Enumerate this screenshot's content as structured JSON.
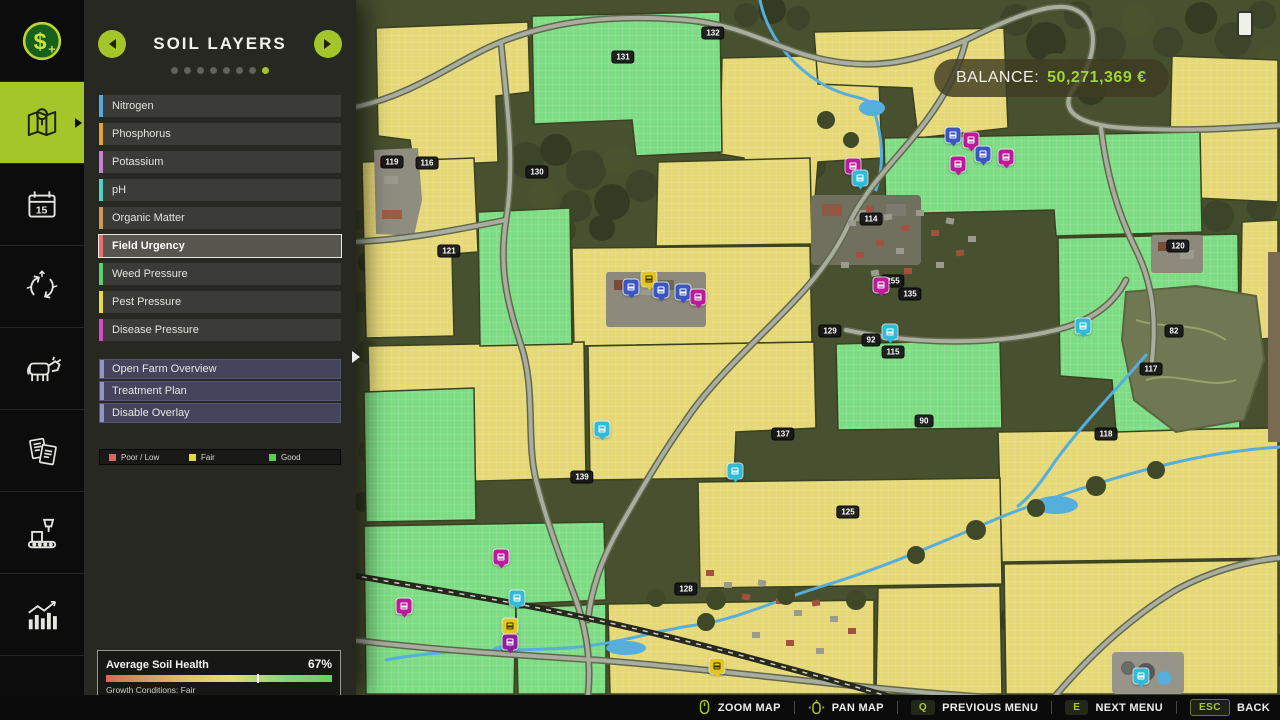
{
  "sidebar": {
    "items": [
      {
        "icon": "money",
        "active": false
      },
      {
        "icon": "map",
        "active": true
      },
      {
        "icon": "calendar",
        "active": false
      },
      {
        "icon": "crop-rotation",
        "active": false
      },
      {
        "icon": "animals",
        "active": false
      },
      {
        "icon": "contracts",
        "active": false
      },
      {
        "icon": "production",
        "active": false
      },
      {
        "icon": "statistics",
        "active": false
      },
      {
        "icon": "help",
        "active": false
      }
    ]
  },
  "panel": {
    "title": "SOIL LAYERS",
    "dots_total": 8,
    "dot_active_index": 7,
    "layers": [
      {
        "label": "Nitrogen",
        "color": "#5aa8e0"
      },
      {
        "label": "Phosphorus",
        "color": "#e0a33c"
      },
      {
        "label": "Potassium",
        "color": "#c77fd4"
      },
      {
        "label": "pH",
        "color": "#4fd4c8"
      },
      {
        "label": "Organic Matter",
        "color": "#cf9a52"
      },
      {
        "label": "Field Urgency",
        "color": "#e8706c"
      },
      {
        "label": "Weed Pressure",
        "color": "#5ccf6e"
      },
      {
        "label": "Pest Pressure",
        "color": "#e8d84a"
      },
      {
        "label": "Disease Pressure",
        "color": "#d84ac4"
      }
    ],
    "selected_layer_index": 5,
    "actions": [
      {
        "label": "Open Farm Overview"
      },
      {
        "label": "Treatment Plan"
      },
      {
        "label": "Disable Overlay"
      }
    ],
    "legend": [
      {
        "label": "Poor / Low",
        "color": "#e0635c"
      },
      {
        "label": "Fair",
        "color": "#e3d93c"
      },
      {
        "label": "Good",
        "color": "#53cf53"
      }
    ],
    "soil_health": {
      "title": "Average Soil Health",
      "percent": 67,
      "percent_label": "67%",
      "caption": "Growth Conditions: Fair"
    }
  },
  "hud": {
    "balance_label": "BALANCE:",
    "balance_value": "50,271,369 €"
  },
  "bottom_bar": {
    "hints": [
      {
        "icon": "mouse-zoom-icon",
        "label": "ZOOM MAP"
      },
      {
        "icon": "mouse-pan-icon",
        "label": "PAN MAP"
      },
      {
        "key": "Q",
        "label": "PREVIOUS MENU"
      },
      {
        "key": "E",
        "label": "NEXT MENU"
      },
      {
        "key": "ESC",
        "label": "BACK",
        "style": "esc"
      }
    ]
  },
  "map": {
    "colors": {
      "field_fair": "#e6d876",
      "field_good": "#7ddc84",
      "forest": "#47502f",
      "road": "#a9ad9f",
      "water": "#55aedb",
      "icon_blue": "#3a55c4",
      "icon_magenta": "#bc1a9a",
      "icon_cyan": "#2ebcd8",
      "icon_yellow": "#e3c71f",
      "icon_purple": "#8c1fa0"
    },
    "field_badges": [
      {
        "num": "132",
        "x": 357,
        "y": 33
      },
      {
        "num": "131",
        "x": 267,
        "y": 57
      },
      {
        "num": "119",
        "x": 36,
        "y": 162
      },
      {
        "num": "116",
        "x": 71,
        "y": 163
      },
      {
        "num": "130",
        "x": 181,
        "y": 172
      },
      {
        "num": "121",
        "x": 93,
        "y": 251
      },
      {
        "num": "114",
        "x": 515,
        "y": 219
      },
      {
        "num": "120",
        "x": 822,
        "y": 246
      },
      {
        "num": "255",
        "x": 537,
        "y": 281
      },
      {
        "num": "135",
        "x": 554,
        "y": 294
      },
      {
        "num": "129",
        "x": 474,
        "y": 331
      },
      {
        "num": "92",
        "x": 515,
        "y": 340
      },
      {
        "num": "115",
        "x": 537,
        "y": 352
      },
      {
        "num": "82",
        "x": 818,
        "y": 331
      },
      {
        "num": "117",
        "x": 795,
        "y": 369
      },
      {
        "num": "90",
        "x": 568,
        "y": 421
      },
      {
        "num": "118",
        "x": 750,
        "y": 434
      },
      {
        "num": "137",
        "x": 427,
        "y": 434
      },
      {
        "num": "139",
        "x": 226,
        "y": 477
      },
      {
        "num": "125",
        "x": 492,
        "y": 512
      },
      {
        "num": "128",
        "x": 330,
        "y": 589
      }
    ],
    "icons": [
      {
        "type": "shop",
        "color": "icon_yellow",
        "x": 293,
        "y": 285
      },
      {
        "type": "silo",
        "color": "icon_blue",
        "x": 275,
        "y": 293
      },
      {
        "type": "silo",
        "color": "icon_blue",
        "x": 305,
        "y": 296
      },
      {
        "type": "silo",
        "color": "icon_blue",
        "x": 327,
        "y": 298
      },
      {
        "type": "factory",
        "color": "icon_magenta",
        "x": 342,
        "y": 303
      },
      {
        "type": "factory",
        "color": "icon_magenta",
        "x": 497,
        "y": 172
      },
      {
        "type": "production",
        "color": "icon_cyan",
        "x": 504,
        "y": 184
      },
      {
        "type": "silo",
        "color": "icon_blue",
        "x": 597,
        "y": 141
      },
      {
        "type": "factory",
        "color": "icon_magenta",
        "x": 615,
        "y": 146
      },
      {
        "type": "silo",
        "color": "icon_blue",
        "x": 627,
        "y": 160
      },
      {
        "type": "factory",
        "color": "icon_magenta",
        "x": 602,
        "y": 170
      },
      {
        "type": "factory",
        "color": "icon_magenta",
        "x": 650,
        "y": 163
      },
      {
        "type": "factory",
        "color": "icon_magenta",
        "x": 525,
        "y": 291
      },
      {
        "type": "production",
        "color": "icon_cyan",
        "x": 534,
        "y": 338
      },
      {
        "type": "production",
        "color": "icon_cyan",
        "x": 727,
        "y": 332
      },
      {
        "type": "train",
        "color": "icon_cyan",
        "x": 246,
        "y": 435
      },
      {
        "type": "production",
        "color": "icon_cyan",
        "x": 379,
        "y": 477
      },
      {
        "type": "factory",
        "color": "icon_magenta",
        "x": 145,
        "y": 563
      },
      {
        "type": "production",
        "color": "icon_cyan",
        "x": 161,
        "y": 604
      },
      {
        "type": "factory",
        "color": "icon_magenta",
        "x": 48,
        "y": 612
      },
      {
        "type": "shop",
        "color": "icon_yellow",
        "x": 154,
        "y": 632
      },
      {
        "type": "factory",
        "color": "icon_purple",
        "x": 154,
        "y": 648
      },
      {
        "type": "shop",
        "color": "icon_yellow",
        "x": 361,
        "y": 672
      },
      {
        "type": "production",
        "color": "icon_cyan",
        "x": 785,
        "y": 682
      }
    ]
  }
}
